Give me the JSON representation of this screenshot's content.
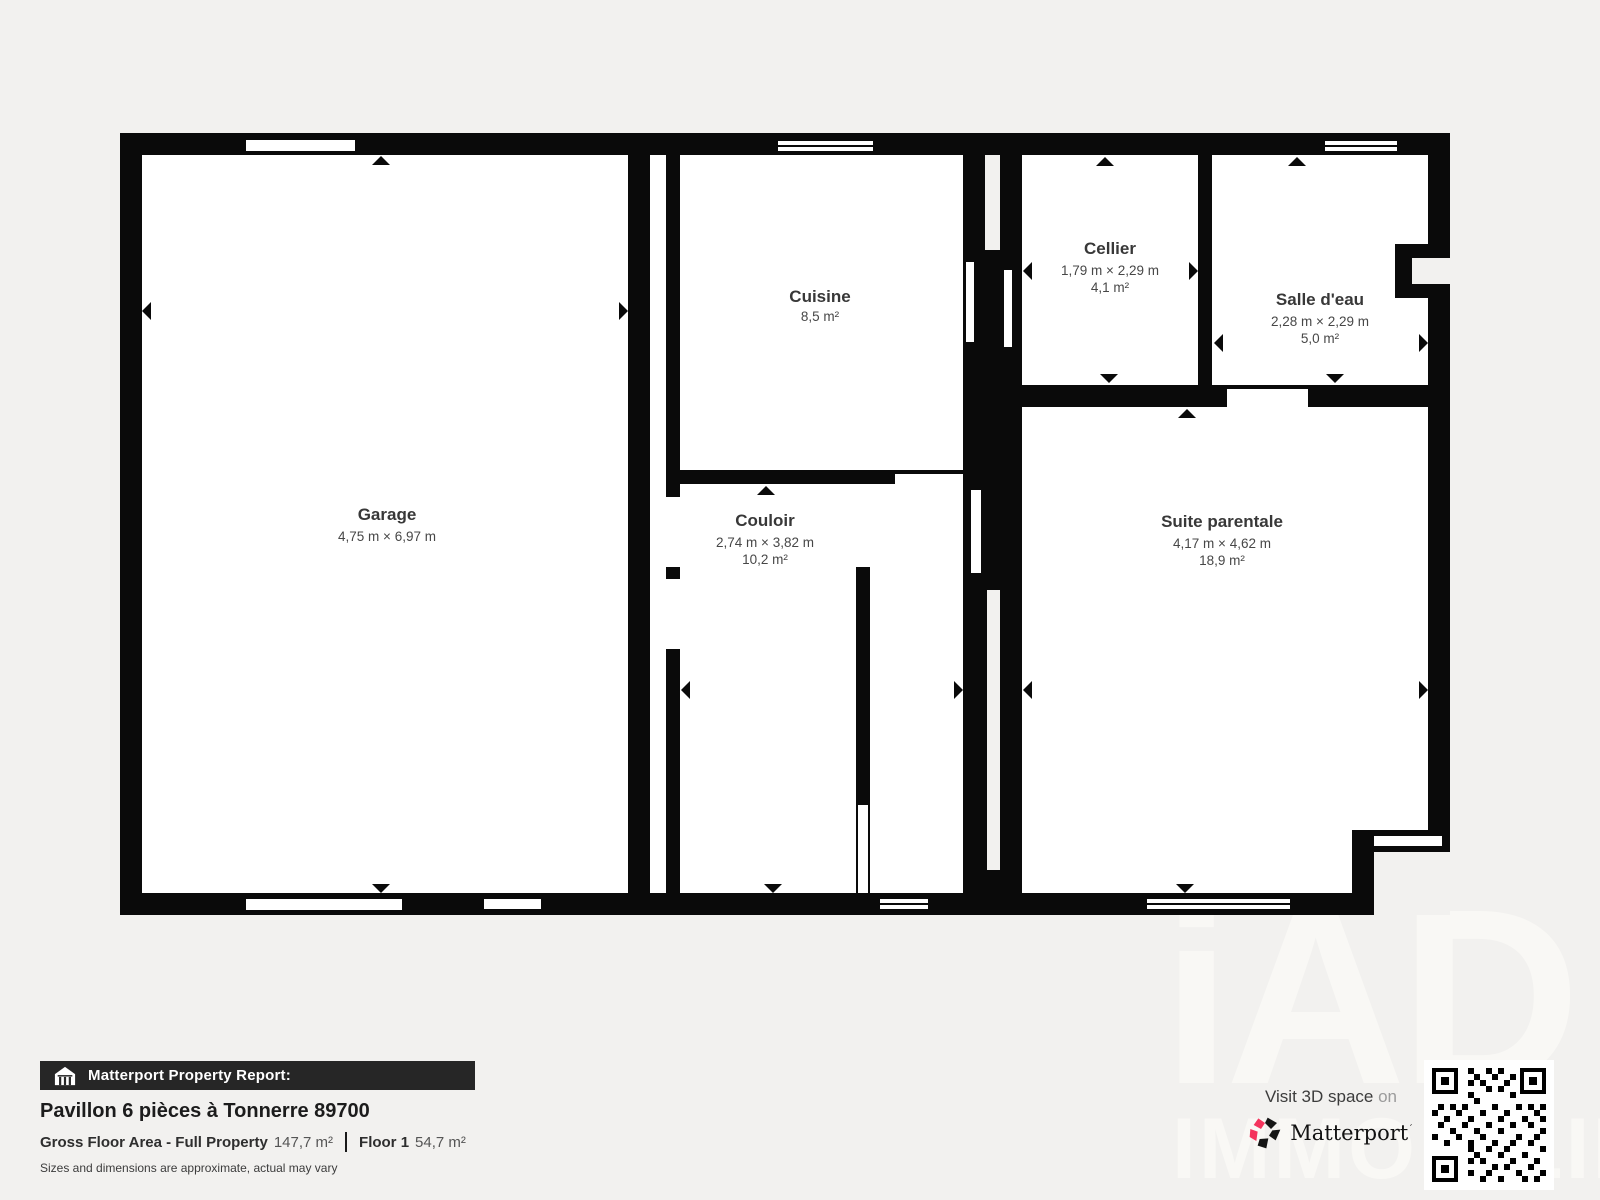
{
  "rooms": [
    {
      "id": "garage",
      "name": "Garage",
      "dims": "4,75 m × 6,97 m",
      "area": ""
    },
    {
      "id": "cuisine",
      "name": "Cuisine",
      "dims": "",
      "area": "8,5 m²"
    },
    {
      "id": "cellier",
      "name": "Cellier",
      "dims": "1,79 m × 2,29 m",
      "area": "4,1 m²"
    },
    {
      "id": "salle-deau",
      "name": "Salle d'eau",
      "dims": "2,28 m × 2,29 m",
      "area": "5,0 m²"
    },
    {
      "id": "couloir",
      "name": "Couloir",
      "dims": "2,74 m × 3,82 m",
      "area": "10,2 m²"
    },
    {
      "id": "suite-parentale",
      "name": "Suite parentale",
      "dims": "4,17 m × 4,62 m",
      "area": "18,9 m²"
    }
  ],
  "report": {
    "bar_label": "Matterport Property Report:",
    "title": "Pavillon 6 pièces à Tonnerre 89700",
    "gfa_label": "Gross Floor Area - Full Property",
    "gfa_value": "147,7 m²",
    "floor_label": "Floor 1",
    "floor_value": "54,7 m²",
    "disclaimer": "Sizes and dimensions are approximate, actual may vary"
  },
  "branding": {
    "visit_text": "Visit 3D space",
    "visit_on": " on",
    "logo_text": "Matterport",
    "watermark_line1": "iAD",
    "watermark_line2": "IMMOBILIER",
    "icons": [
      "house-icon",
      "matterport-pinwheel-icon",
      "qr-code"
    ],
    "colors": {
      "accent_pink": "#f4345d",
      "wall": "#0a0a0a",
      "background": "#f2f1ef",
      "bar_background": "#262626"
    }
  }
}
